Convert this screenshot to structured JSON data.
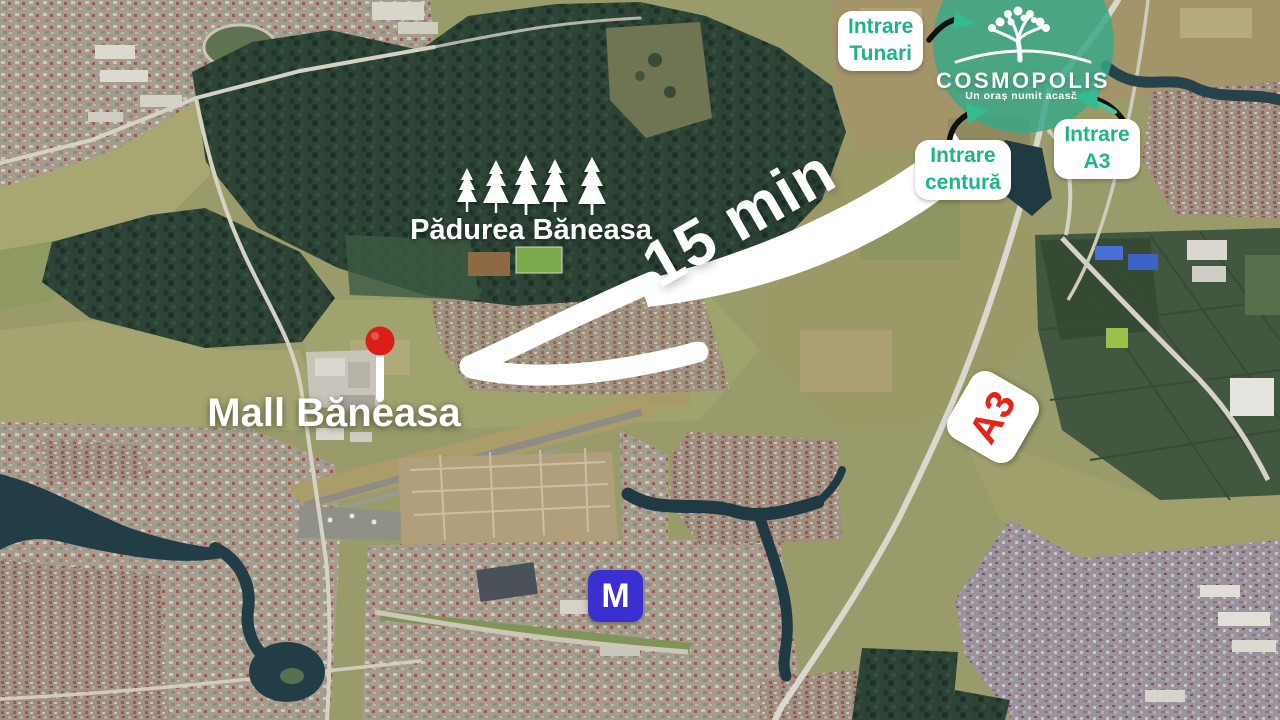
{
  "map_overlay": {
    "travel_time": "15 min",
    "forest_label": "Pădurea Băneasa",
    "mall_label": "Mall Băneasa",
    "highway_badge": "A3",
    "metro_symbol": "M",
    "entrances": {
      "tunari": "Intrare\nTunari",
      "centura": "Intrare\ncentură",
      "a3": "Intrare\nA3"
    }
  },
  "logo": {
    "name": "COSMOPOLIS",
    "tagline": "Un oraș numit acasă."
  },
  "colors": {
    "brand_green": "#1fb388",
    "mint_arrow": "#3ec79b",
    "logo_circle": "#37a888",
    "pin_red": "#da1f16",
    "highway_red": "#e22718",
    "metro_blue": "#3c2fd0",
    "label_white": "#ffffff"
  }
}
